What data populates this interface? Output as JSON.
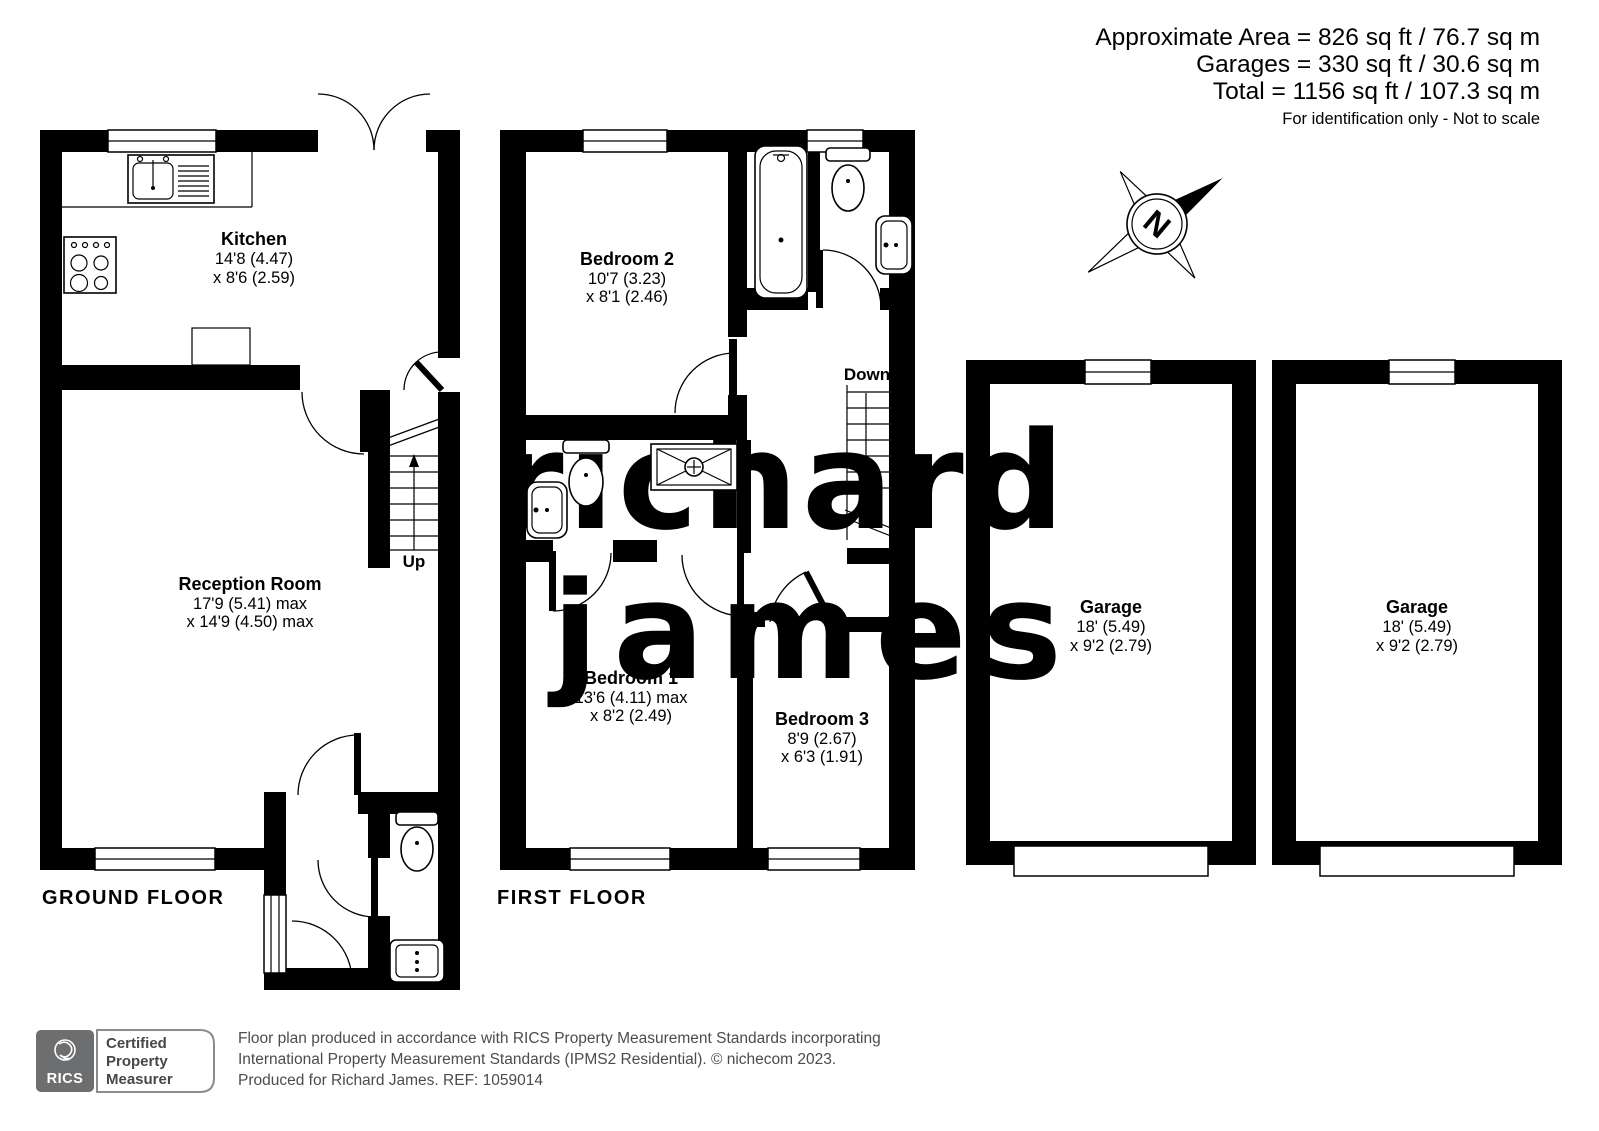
{
  "header": {
    "line1": "Approximate Area = 826 sq ft / 76.7 sq m",
    "line2": "Garages = 330 sq ft / 30.6 sq m",
    "line3": "Total = 1156 sq ft / 107.3 sq m",
    "disclaimer": "For identification only - Not to scale"
  },
  "compass": {
    "letter": "N"
  },
  "watermark": {
    "line1": "richard",
    "line2": "james",
    "color": "#b6bdcc"
  },
  "floors": {
    "ground": {
      "label": "GROUND FLOOR",
      "stairs": "Up",
      "rooms": {
        "kitchen": {
          "name": "Kitchen",
          "dim1": "14'8 (4.47)",
          "dim2": "x 8'6 (2.59)"
        },
        "reception": {
          "name": "Reception Room",
          "dim1": "17'9 (5.41) max",
          "dim2": "x 14'9 (4.50) max"
        }
      }
    },
    "first": {
      "label": "FIRST FLOOR",
      "stairs": "Down",
      "rooms": {
        "bedroom2": {
          "name": "Bedroom 2",
          "dim1": "10'7 (3.23)",
          "dim2": "x 8'1 (2.46)"
        },
        "bedroom1": {
          "name": "Bedroom 1",
          "dim1": "13'6 (4.11) max",
          "dim2": "x 8'2 (2.49)"
        },
        "bedroom3": {
          "name": "Bedroom 3",
          "dim1": "8'9 (2.67)",
          "dim2": "x 6'3 (1.91)"
        }
      }
    },
    "garage1": {
      "name": "Garage",
      "dim1": "18' (5.49)",
      "dim2": "x 9'2 (2.79)"
    },
    "garage2": {
      "name": "Garage",
      "dim1": "18' (5.49)",
      "dim2": "x 9'2 (2.79)"
    }
  },
  "footer": {
    "rics": "RICS",
    "badge": {
      "line1": "Certified",
      "line2": "Property",
      "line3": "Measurer"
    },
    "line1": "Floor plan produced in accordance with RICS Property Measurement Standards incorporating",
    "line2": "International Property Measurement Standards (IPMS2 Residential).   © nichecom 2023.",
    "line3": "Produced for Richard James.   REF:  1059014"
  }
}
